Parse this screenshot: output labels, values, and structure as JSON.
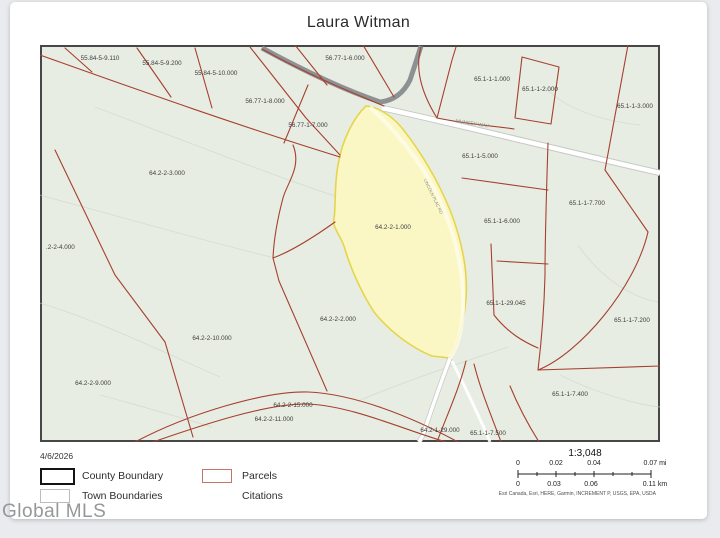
{
  "page": {
    "title": "Laura Witman",
    "watermark": "Global MLS"
  },
  "legend": {
    "date": "4/6/2026",
    "items": [
      {
        "label": "County Boundary",
        "swatch": "black-outline"
      },
      {
        "label": "Parcels",
        "swatch": "red-outline"
      },
      {
        "label": "Town Boundaries",
        "swatch": "gray-outline"
      },
      {
        "label": "Citations",
        "swatch": "none"
      }
    ]
  },
  "scale": {
    "ratio": "1:3,048",
    "mi_ticks": [
      {
        "t": "0",
        "x": 3
      },
      {
        "t": "0.02",
        "x": 41
      },
      {
        "t": "0.04",
        "x": 79
      },
      {
        "t": "0.07 mi",
        "x": 140
      }
    ],
    "km_ticks": [
      {
        "t": "0",
        "x": 3
      },
      {
        "t": "0.03",
        "x": 39
      },
      {
        "t": "0.06",
        "x": 76
      },
      {
        "t": "0.11 km",
        "x": 140
      }
    ],
    "attribution": "Esri Canada, Esri, HERE, Garmin, INCREMENT P, USGS, EPA, USDA"
  },
  "map": {
    "highlighted_parcel": "64.2-2-1.000",
    "colors": {
      "map_bg": "#e8ede3",
      "parcel_line": "#a6402f",
      "highlight_fill": "#fbf7c5",
      "highlight_stroke": "#e5d54d",
      "gray_road": "#8e9194"
    },
    "parcel_labels": [
      {
        "text": "55.84-5-9.110",
        "x": 60,
        "y": 15
      },
      {
        "text": "55.84-5-9.200",
        "x": 122,
        "y": 20
      },
      {
        "text": "55.84-5-10.000",
        "x": 176,
        "y": 30
      },
      {
        "text": "56.77-1-6.000",
        "x": 305,
        "y": 15
      },
      {
        "text": "56.77-1-8.000",
        "x": 225,
        "y": 58
      },
      {
        "text": "56.77-1-7.000",
        "x": 268,
        "y": 82
      },
      {
        "text": "65.1-1-1.000",
        "x": 452,
        "y": 36
      },
      {
        "text": "65.1-1-2.000",
        "x": 500,
        "y": 46
      },
      {
        "text": "65.1-1-3.000",
        "x": 595,
        "y": 63
      },
      {
        "text": "64.2-2-3.000",
        "x": 127,
        "y": 130
      },
      {
        "text": ".2-2-4.000",
        "x": 6,
        "y": 204,
        "anchor": "start"
      },
      {
        "text": "64.2-2-1.000",
        "x": 353,
        "y": 184
      },
      {
        "text": "65.1-1-5.000",
        "x": 440,
        "y": 113
      },
      {
        "text": "65.1-1-6.000",
        "x": 462,
        "y": 178
      },
      {
        "text": "65.1-1-7.700",
        "x": 547,
        "y": 160
      },
      {
        "text": "65.1-1-29.045",
        "x": 466,
        "y": 260
      },
      {
        "text": "65.1-1-7.200",
        "x": 592,
        "y": 277
      },
      {
        "text": "64.2-2-2.000",
        "x": 298,
        "y": 276
      },
      {
        "text": "64.2-2-10.000",
        "x": 172,
        "y": 295
      },
      {
        "text": "64.2-2-9.000",
        "x": 53,
        "y": 340
      },
      {
        "text": "64.2-2-15.000",
        "x": 253,
        "y": 362
      },
      {
        "text": "64.2-2-11.000",
        "x": 234,
        "y": 376
      },
      {
        "text": "64.2-1-29.000",
        "x": 400,
        "y": 387
      },
      {
        "text": "65.1-1-7.500",
        "x": 448,
        "y": 390
      },
      {
        "text": "65.1-1-7.400",
        "x": 530,
        "y": 351
      }
    ],
    "road_labels": [
      {
        "text": "MUNSEY WAY",
        "x": 432,
        "y": 80,
        "rotate": 9,
        "size": 5
      },
      {
        "text": "LINCOLN PLAC RD",
        "x": 392,
        "y": 152,
        "rotate": 64,
        "size": 4.3
      }
    ]
  }
}
